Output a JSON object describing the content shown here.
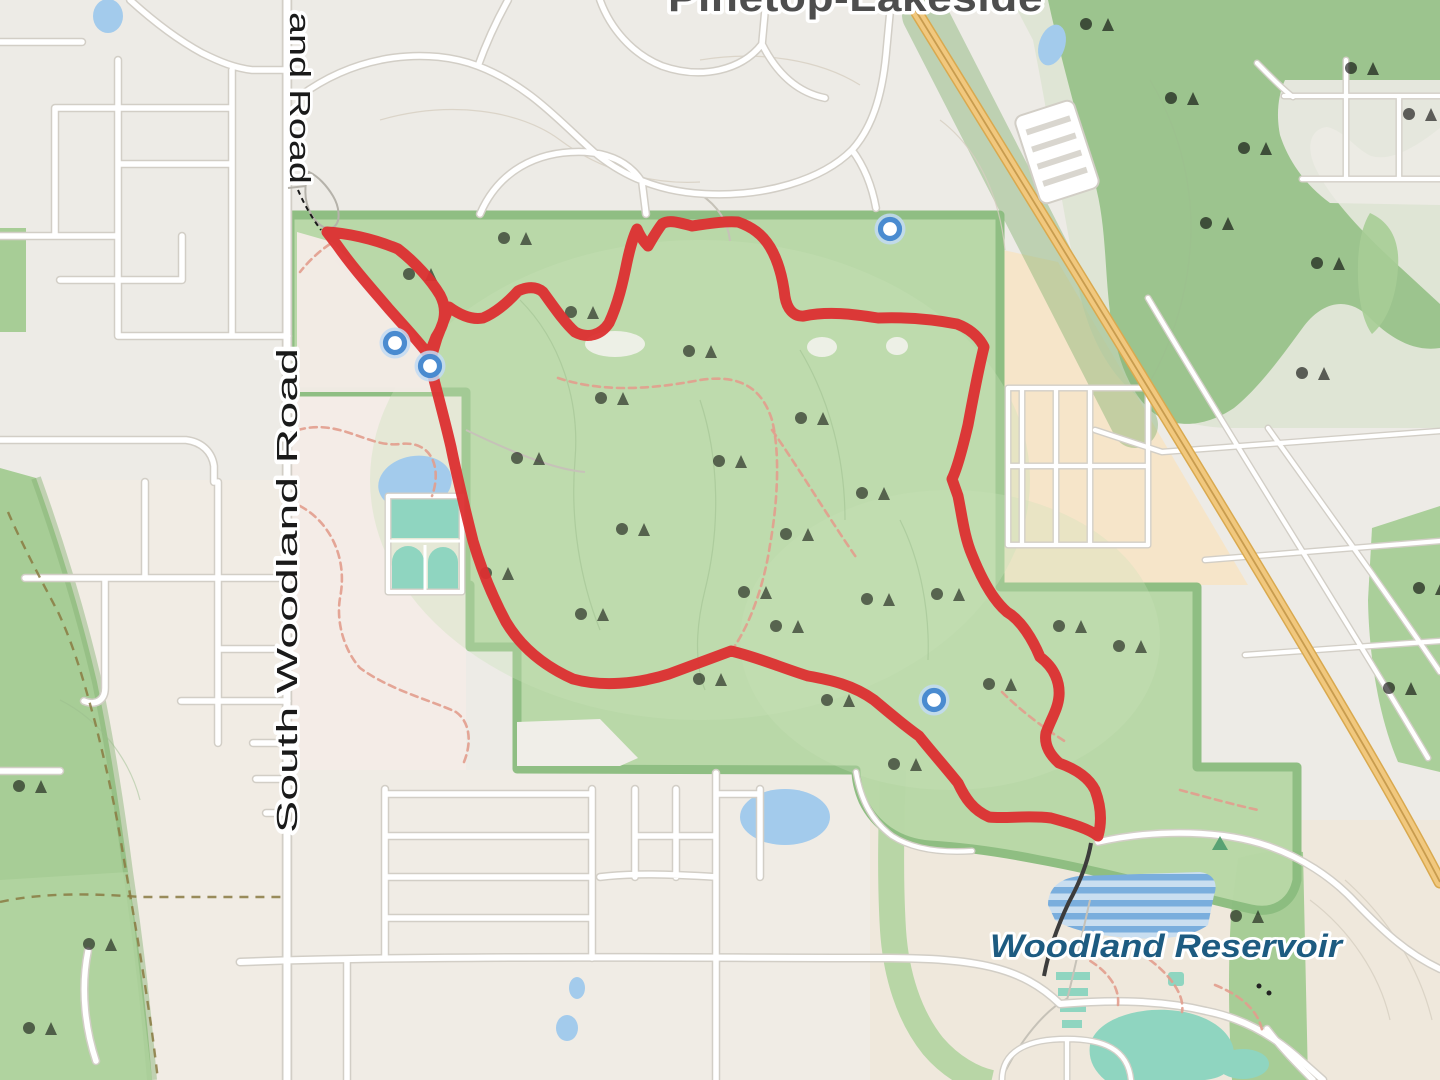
{
  "map": {
    "labels": {
      "city": "Pinetop-Lakeside",
      "road_partial": "and Road",
      "road_main": "South Woodland Road",
      "water": "Woodland Reservoir"
    },
    "markers": [
      {
        "x": 890,
        "y": 229
      },
      {
        "x": 395,
        "y": 343
      },
      {
        "x": 430,
        "y": 366
      },
      {
        "x": 934,
        "y": 700
      }
    ],
    "colors": {
      "trail": "#dc2f30",
      "marker_ring": "#4a8bd0",
      "marker_halo": "#c2dbf3",
      "park_fill": "#b8d8a6",
      "park_edge": "#8cbd80",
      "park_light": "#c9e2b8",
      "forest": "#9cc48e",
      "forest_dark": "#86b173",
      "sage": "#d3e0c6",
      "green_left": "#a7cd96",
      "green_soft": "#b4d5a2",
      "water": "#a3cbec",
      "teal": "#8fd5c0",
      "resv_dark": "#7aaedd",
      "resv_light": "#c9def0",
      "hwy": "#f1c87e",
      "hwy_edge": "#d9a94f",
      "hwy_line": "#c89c4e",
      "road": "#ffffff",
      "casing": "#d2cec6",
      "bg": "#edebe6",
      "bg_pink": "#f4ece7",
      "bg_warm": "#f1ece4",
      "bg_beige": "#efe8dc",
      "trail_path": "#e29d8d",
      "boundary": "#8a7a42",
      "contour": "#d6cec0",
      "contour_green": "#9cbe8e",
      "label_dark": "#1a1a1a",
      "label_city": "#4e4e4e",
      "label_water": "#1d5b81",
      "tree": "#69935e",
      "tree_dark": "#5a7f52",
      "black_line": "#3c3c3c"
    }
  }
}
